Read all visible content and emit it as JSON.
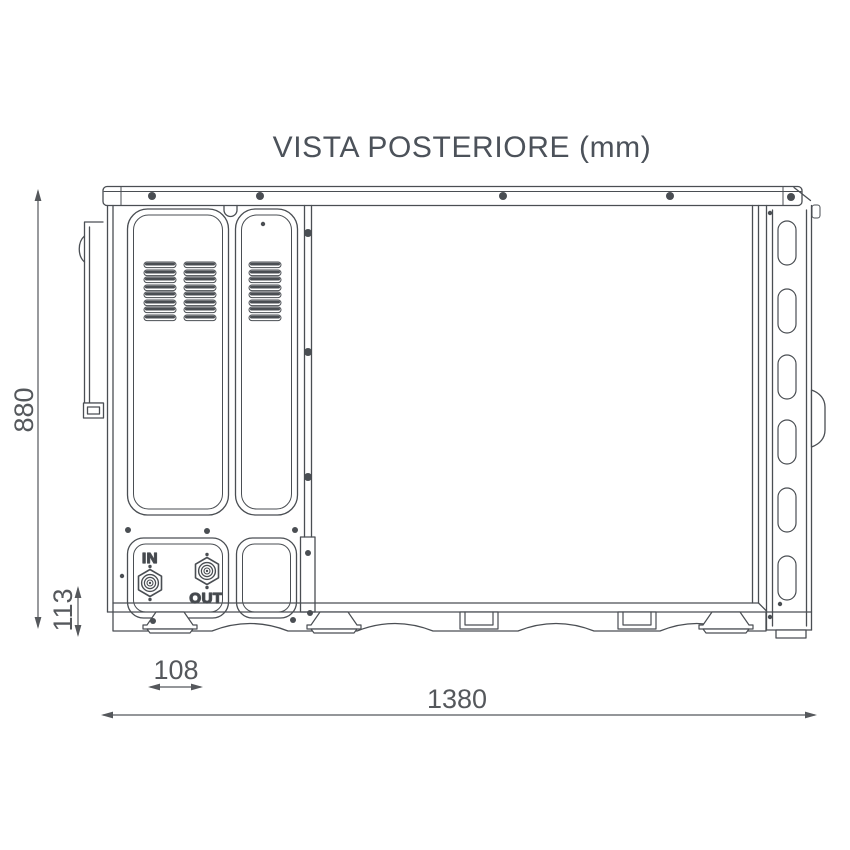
{
  "title": "VISTA POSTERIORE (mm)",
  "units": "mm",
  "labels": {
    "inlet": "IN",
    "outlet": "OUT"
  },
  "dimensions": {
    "overall_height": "880",
    "inlet_height": "113",
    "foot_offset": "108",
    "overall_width": "1380"
  },
  "colors": {
    "line": "#4a4e53",
    "dimension_text": "#55585c",
    "title_text": "#4c525a",
    "background": "#ffffff"
  }
}
